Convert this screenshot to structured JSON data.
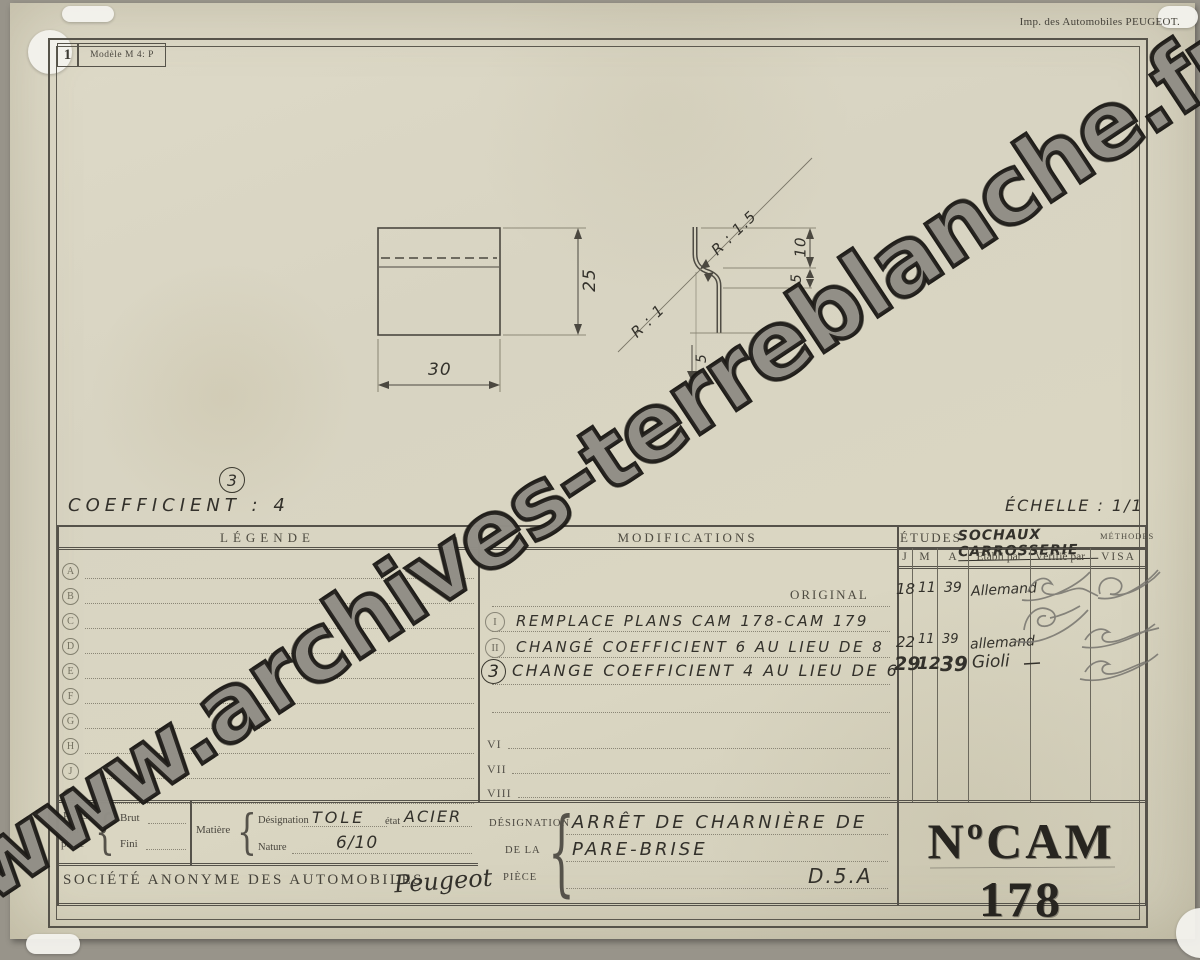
{
  "page": {
    "sheet_number": "1",
    "model": "Modèle M 4: P",
    "imprint": "Imp. des Automobiles PEUGEOT.",
    "watermark": "www.archives-terreblanche.fr",
    "coefficient": "COEFFICIENT : 4",
    "revision_mark": "3",
    "scale": "ÉCHELLE : 1/1",
    "ink_color": "#45423a",
    "paper_color": "#d8d4c2"
  },
  "drawing": {
    "front_view": {
      "width_dim": "30",
      "height_dim": "25"
    },
    "profile_view": {
      "dim_top": "10",
      "dim_mid": "5",
      "dim_bottom": "5",
      "radius_top": "R : 1.5",
      "radius_bottom": "R : 1"
    }
  },
  "legende": {
    "title": "LÉGENDE",
    "rows": [
      "A",
      "B",
      "C",
      "D",
      "E",
      "F",
      "G",
      "H",
      "J",
      "K"
    ]
  },
  "modifications": {
    "title": "MODIFICATIONS",
    "original_label": "ORIGINAL",
    "rows": [
      {
        "mark": "I",
        "text": "REMPLACE PLANS CAM 178-CAM 179"
      },
      {
        "mark": "II",
        "text": "CHANGÉ COEFFICIENT 6 AU LIEU DE 8"
      },
      {
        "mark": "3",
        "text": "CHANGE COEFFICIENT 4 AU LIEU DE 6"
      }
    ],
    "empty_rows": [
      "VI",
      "VII",
      "VIII"
    ]
  },
  "etudes": {
    "title": "ÉTUDES",
    "department": "SOCHAUX CARROSSERIE",
    "methodes_label": "MÉTHODES",
    "columns": [
      "J",
      "M",
      "A",
      "Etabli par",
      "Vérifié par",
      "VISA"
    ],
    "rows": [
      {
        "j": "18",
        "m": "11",
        "a": "39",
        "etabli": "Allemand"
      },
      {
        "j": "22",
        "m": "11",
        "a": "39",
        "etabli": "allemand"
      },
      {
        "j": "29",
        "m": "12",
        "a": "39",
        "etabli": "Gioli"
      }
    ]
  },
  "cartouche": {
    "poids_line1": "Poids",
    "poids_line2": "par",
    "poids_line3": "pièce",
    "brut_label": "Brut",
    "fini_label": "Fini",
    "matiere_label": "Matière",
    "designation_label": "Désignation",
    "designation_value": "TOLE",
    "etat_label": "état",
    "etat_value": "ACIER",
    "nature_label": "Nature",
    "nature_value": "6/10",
    "societe": "SOCIÉTÉ ANONYME DES AUTOMOBILES",
    "brand": "Peugeot",
    "piece_label_line1": "DÉSIGNATION",
    "piece_label_line2": "DE LA",
    "piece_label_line3": "PIÈCE",
    "piece_name_line1": "ARRÊT DE CHARNIÈRE DE",
    "piece_name_line2": "PARE-BRISE",
    "piece_ref": "D.5.A",
    "number": "NºCAM 178"
  }
}
